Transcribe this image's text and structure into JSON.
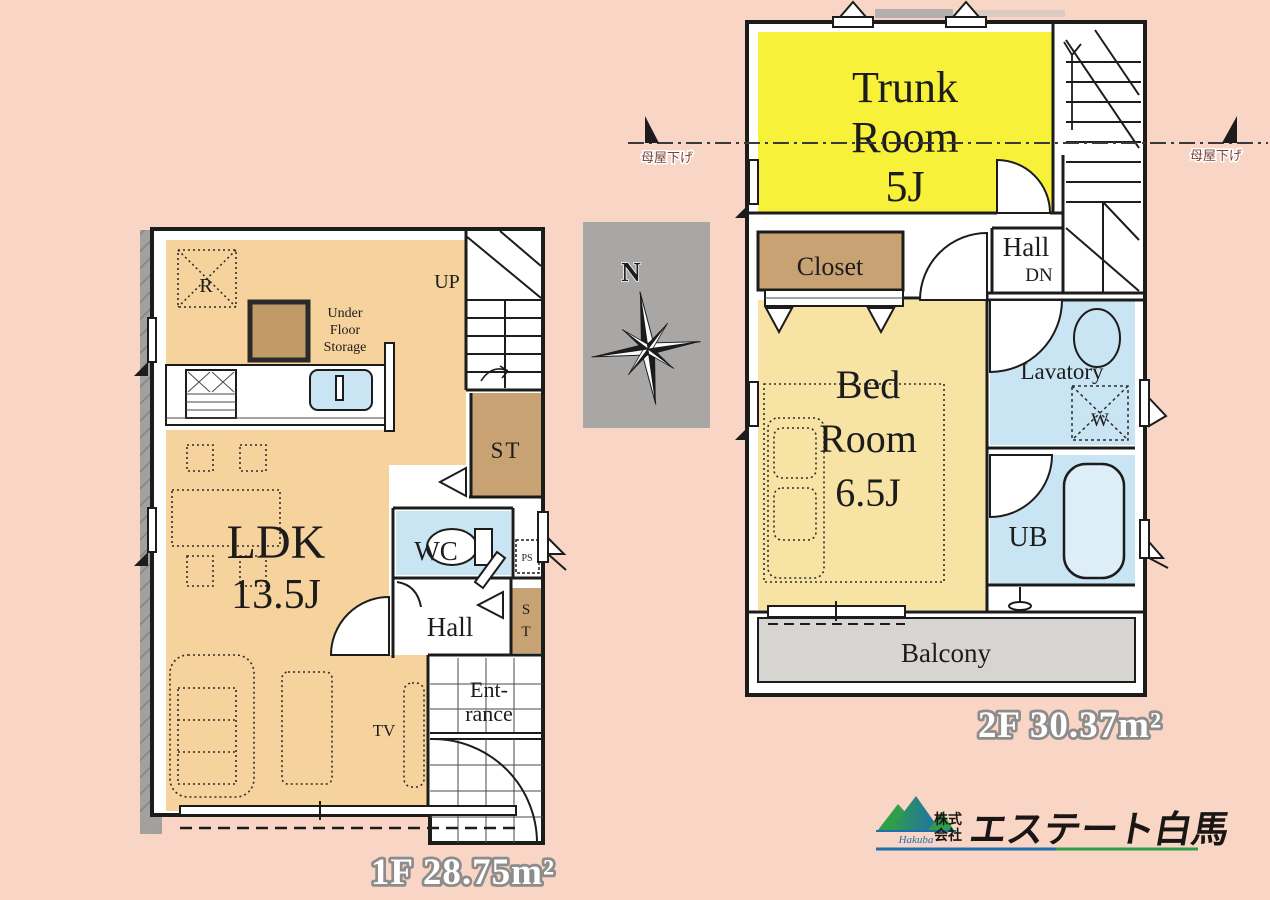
{
  "colors": {
    "bg": "#f8d5c5",
    "wall": "#1c1c1c",
    "ldk": "#f6d29c",
    "bedroom": "#f7e3a4",
    "trunk": "#f7f13a",
    "water": "#c9e4f3",
    "tub": "#ddeef8",
    "storage": "#c9a273",
    "underfloor": "#c19a67",
    "balcony": "#d7d5d2",
    "compass_bg": "#a9a7a5",
    "strip": "#a3a19f",
    "note": "#7a4034",
    "area_outline": "#8e8c8a",
    "logo_green": "#2f9e49",
    "logo_blue": "#1f6fae"
  },
  "floor1": {
    "area_label": "1F 28.75m²",
    "rooms": {
      "ldk": "LDK",
      "ldk_size": "13.5J",
      "wc": "WC",
      "hall": "Hall",
      "entrance1": "Ent-",
      "entrance2": "rance",
      "st_main": "ST",
      "st_side_s": "S",
      "st_side_t": "T",
      "refrigerator": "R",
      "underfloor1": "Under",
      "underfloor2": "Floor",
      "underfloor3": "Storage",
      "stairs_up": "UP",
      "tv": "TV",
      "pipe_space": "PS"
    }
  },
  "floor2": {
    "area_label": "2F 30.37m²",
    "rooms": {
      "trunk1": "Trunk",
      "trunk2": "Room",
      "trunk3": "5J",
      "closet": "Closet",
      "bed1": "Bed",
      "bed2": "Room",
      "bed3": "6.5J",
      "hall": "Hall",
      "stairs_down": "DN",
      "lavatory": "Lavatory",
      "washer": "W",
      "unit_bath": "UB",
      "balcony": "Balcony"
    }
  },
  "compass": {
    "north": "N"
  },
  "roof_notes": {
    "left": "母屋下げ",
    "right": "母屋下げ"
  },
  "logo": {
    "prefix_top": "株式",
    "prefix_bottom": "会社",
    "company": "エステート白馬",
    "romaji": "Hakuba"
  }
}
